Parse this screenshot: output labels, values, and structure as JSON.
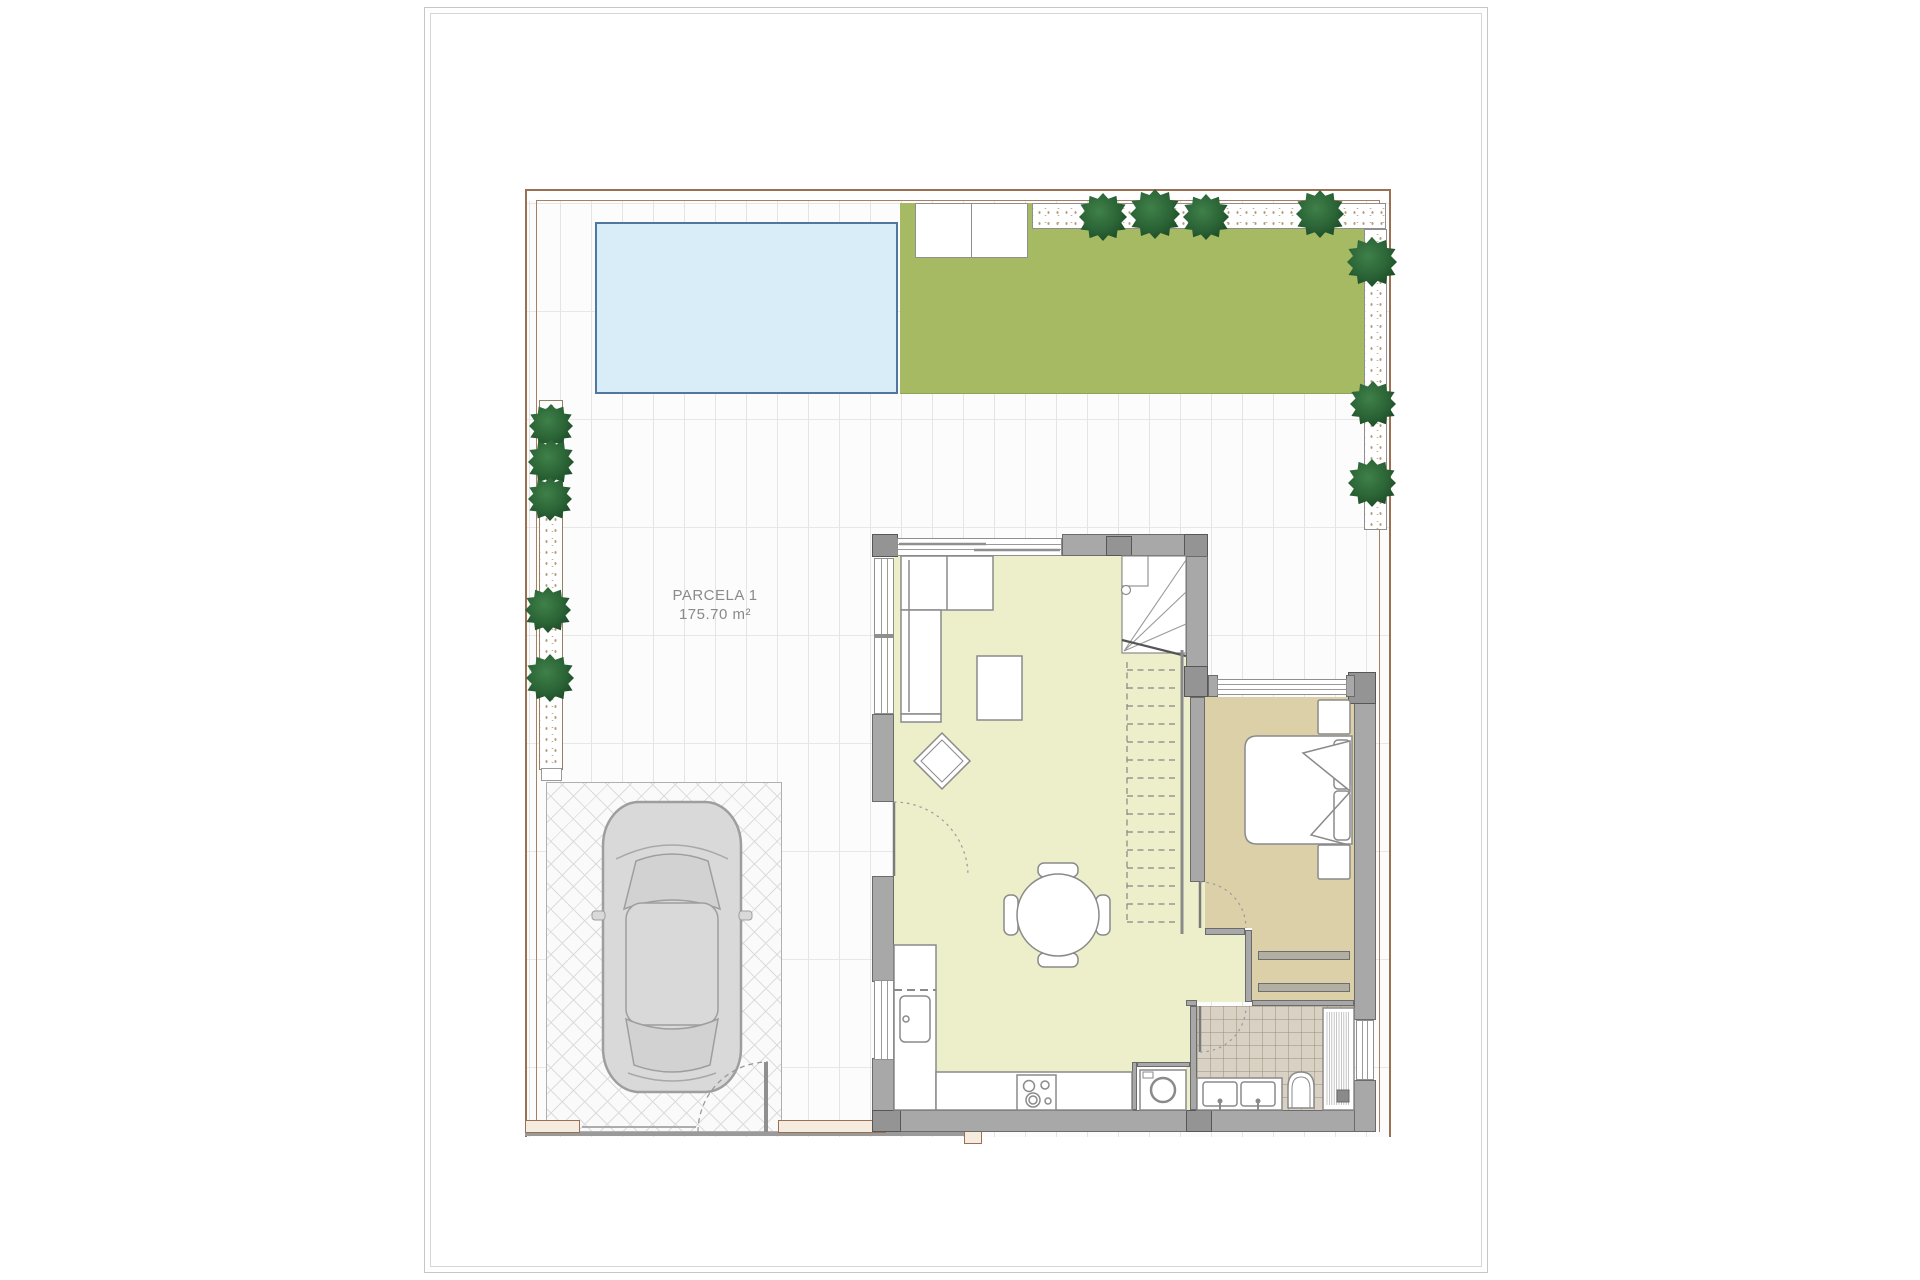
{
  "labels": {
    "parcel_name": "PARCELA 1",
    "parcel_area": "175.70 m²"
  },
  "palette": {
    "page_border": "#c6c6c6",
    "plot_border": "#9b6f52",
    "tile_line": "#e4e4e4",
    "pool_fill": "#d9edf8",
    "pool_border": "#52779e",
    "lawn_green": "#a5ba62",
    "gravel_dot": "#b09a7d",
    "wall_gray": "#a8a8a8",
    "wall_column_gray": "#949494",
    "living_floor": "#edeeca",
    "bedroom_floor": "#dcd0a9",
    "bathroom_floor": "#d8d1c4",
    "furniture_stroke": "#8a8a8a",
    "tree_green": "#2c6637",
    "label_text": "#8a8a8a"
  },
  "landscape": {
    "trees": [
      {
        "name": "tree-icon",
        "x": 551,
        "y": 426,
        "s": 44
      },
      {
        "name": "tree-icon",
        "x": 551,
        "y": 462,
        "s": 46
      },
      {
        "name": "tree-icon",
        "x": 550,
        "y": 499,
        "s": 44
      },
      {
        "name": "tree-icon",
        "x": 548,
        "y": 610,
        "s": 46
      },
      {
        "name": "tree-icon",
        "x": 550,
        "y": 678,
        "s": 48
      },
      {
        "name": "tree-icon",
        "x": 1103,
        "y": 217,
        "s": 48
      },
      {
        "name": "tree-icon",
        "x": 1155,
        "y": 214,
        "s": 50
      },
      {
        "name": "tree-icon",
        "x": 1206,
        "y": 217,
        "s": 46
      },
      {
        "name": "tree-icon",
        "x": 1320,
        "y": 214,
        "s": 48
      },
      {
        "name": "tree-icon",
        "x": 1372,
        "y": 262,
        "s": 50
      },
      {
        "name": "tree-icon",
        "x": 1373,
        "y": 404,
        "s": 46
      },
      {
        "name": "tree-icon",
        "x": 1372,
        "y": 483,
        "s": 48
      }
    ]
  },
  "stairs": {
    "dash_top": 670,
    "dash_bottom": 922,
    "dash_step": 18,
    "x1": 1127,
    "x2": 1179
  },
  "shower": {
    "x1": 1327,
    "x2": 1351,
    "step": 2.4,
    "y1": 1012,
    "y2": 1105
  }
}
